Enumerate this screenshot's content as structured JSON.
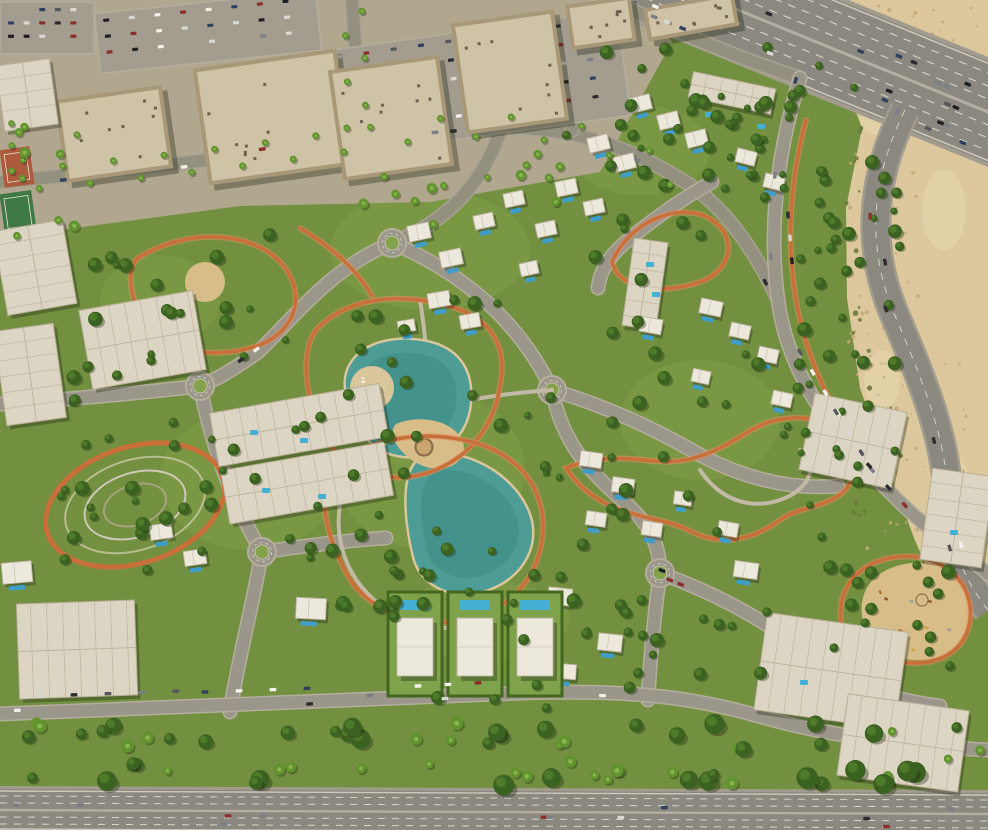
{
  "scene": {
    "canvas": {
      "w": 988,
      "h": 830
    },
    "palette": {
      "grass": "#72903f",
      "grassLight": "#84a24c",
      "treeDark": "#3c6222",
      "tree": "#4e7b2a",
      "treeLight": "#6d9b3c",
      "palm": "#61942f",
      "palmLight": "#8ab44e",
      "pavement": "#b1a78f",
      "plaza": "#bcb29a",
      "desert": "#dcc89c",
      "desertLight": "#e6d6ae",
      "desertSpeckle": "#c4a878",
      "shrub": "#6b7a3a",
      "road": "#9b968a",
      "roadCasing": "#b6ae9d",
      "highway": "#8b8880",
      "laneWhite": "#e8e4d8",
      "laneSoft": "#b5afa2",
      "track": "#c96f3a",
      "trackLight": "#e09263",
      "lake": "#4d9c96",
      "lakeDeep": "#3b8781",
      "sandEdge": "#d9c79b",
      "sand": "#d8bd88",
      "pool": "#3e9ec9",
      "poolLight": "#45b0d6",
      "villa": "#ece8dc",
      "villaLine": "#bdb4a0",
      "aptRoof": "#ddd5c3",
      "aptLine": "#b9ae97",
      "wall": "#a89878",
      "roof": "#cfc3a7",
      "wallDark": "#97886c",
      "roofDark": "#b3a183",
      "lot": "#a39d90",
      "hedge": "#44671f",
      "plotLawn": "#7ea34a",
      "carColors": [
        "#f2f0ea",
        "#d8d8d4",
        "#2b2b30",
        "#55575c",
        "#8a2f2a",
        "#31405f",
        "#7b7e84",
        "#1f1f24"
      ],
      "shadow": "rgba(30,36,18,0.35)"
    },
    "urbanPoly": "0,0 645,0 672,42 600,172 430,202 240,206 90,226 0,238",
    "desertPoly": "838,0 988,0 988,598 940,598 914,538 888,468 860,388 847,298 846,208 862,128 838,66 812,28",
    "desertPatches": [
      [
        900,
        60,
        70,
        26
      ],
      [
        944,
        210,
        44,
        80
      ],
      [
        882,
        380,
        36,
        60
      ],
      [
        950,
        480,
        36,
        50
      ],
      [
        880,
        120,
        40,
        30
      ]
    ],
    "speckleZones": [
      [
        848,
        6,
        130,
        110,
        60,
        41
      ],
      [
        848,
        150,
        70,
        260,
        50,
        42
      ],
      [
        866,
        350,
        100,
        240,
        55,
        43
      ]
    ],
    "shrubZones": [
      [
        846,
        120,
        40,
        200,
        22,
        44
      ],
      [
        852,
        330,
        50,
        200,
        18,
        45
      ]
    ],
    "grassPatches": [
      [
        430,
        250,
        200,
        120
      ],
      [
        250,
        480,
        180,
        140
      ],
      [
        700,
        420,
        160,
        120
      ],
      [
        640,
        150,
        140,
        90
      ],
      [
        160,
        300,
        120,
        90
      ],
      [
        480,
        620,
        180,
        80
      ],
      [
        430,
        470,
        190,
        160
      ]
    ],
    "highway": {
      "x1": 640,
      "y1": -30,
      "x2": 1020,
      "y2": 125,
      "half": 47,
      "dashOffsets": [
        -36,
        -24,
        -12,
        12,
        24,
        36
      ],
      "edgeOffsets": [
        -45,
        45
      ]
    },
    "bottomHighway": {
      "x1": 0,
      "y1": 810,
      "x2": 988,
      "y2": 814,
      "half": 21,
      "dashOffsets": [
        -14,
        -7,
        7,
        14
      ],
      "edgeOffsets": [
        -19,
        19
      ]
    },
    "ramp": {
      "d": "M 905,110 C 870,180 866,250 896,318 C 922,380 944,432 948,492 C 950,540 960,575 988,610",
      "w": 26
    },
    "streets": [
      "M 0,182 C 130,170 250,156 355,140",
      "M 355,140 C 430,126 500,122 560,132 C 610,140 650,160 690,185 C 720,205 750,240 778,300",
      "M 500,132 C 480,190 440,225 392,243",
      "M 352,0 C 356,52 358,96 355,140",
      "M 608,0 C 600,50 588,95 572,130",
      "M 628,8 C 690,38 750,62 800,78"
    ],
    "roads": [
      "M 392,243 C 330,268 292,320 258,352 C 230,372 215,380 200,386",
      "M 200,386 C 212,448 232,502 262,552",
      "M 262,552 C 252,608 238,660 230,712",
      "M 200,386 C 130,394 60,400 0,404",
      "M 392,243 C 462,272 520,322 552,390",
      "M 552,390 C 562,442 588,470 622,500 C 650,523 660,546 660,573",
      "M 660,573 C 654,618 650,660 648,700",
      "M 660,573 C 716,594 762,618 802,650 C 842,682 888,700 940,706",
      "M 800,78 C 778,150 768,225 778,300 C 790,392 858,462 906,508 C 944,543 968,556 988,574",
      "M 552,390 C 612,408 656,430 702,456 C 744,478 790,490 838,486",
      "M 0,714 C 180,707 360,698 520,693 C 640,689 700,699 762,717 C 824,735 904,746 988,750",
      "M 262,552 C 306,546 348,540 386,538",
      "M 712,182 C 680,200 650,222 628,240 C 610,255 600,270 598,288"
    ],
    "roundabouts": [
      [
        200,
        386
      ],
      [
        262,
        552
      ],
      [
        660,
        573
      ],
      [
        392,
        243
      ],
      [
        552,
        390
      ]
    ],
    "walkPaths": [
      "M 420,300 C 428,350 430,400 432,445",
      "M 352,470 C 330,510 335,560 368,594 C 400,628 450,636 492,620",
      "M 552,390 C 520,392 492,396 470,400",
      "M 700,470 C 720,500 750,510 780,500 C 810,490 820,464 800,450"
    ],
    "tracks": [
      "M 138,258 C 186,228 252,230 282,264 C 306,292 298,328 262,344 C 216,362 158,352 140,316 C 130,294 126,268 138,258 Z",
      "M 316,330 C 344,300 392,292 442,304 C 492,316 508,346 500,386 C 494,426 470,458 430,472 C 390,486 348,472 328,442 C 310,416 296,358 316,330 Z",
      "M 334,470 C 362,440 420,428 472,442 C 524,456 548,494 542,540 C 536,582 506,612 464,620 C 420,629 368,612 348,576 C 330,544 314,498 334,470 Z",
      "M 566,468 C 624,446 652,470 694,458 C 744,444 752,416 802,418 C 842,420 862,448 852,478 C 842,508 802,504 780,520 C 750,542 718,546 688,530 C 658,514 600,520 566,468 Z",
      "M 612,262 C 630,220 682,200 712,220 C 738,238 732,270 700,282 C 664,294 620,292 612,262 Z",
      "M 846,640 C 830,600 850,566 890,558 C 930,550 966,572 970,606 C 974,640 950,664 914,663 C 884,662 856,662 846,640 Z",
      "M 300,228 C 330,246 356,268 372,296",
      "M 806,120 C 790,180 786,240 796,300 C 806,360 836,420 872,470"
    ],
    "ovalPark": {
      "cx": 135,
      "cy": 505,
      "rx": 92,
      "ry": 58,
      "rot": -18,
      "rings": [
        [
          72,
          45
        ],
        [
          52,
          32
        ],
        [
          32,
          20
        ]
      ]
    },
    "lakes": [
      {
        "d": "M 346,386 C 344,356 374,338 410,340 C 452,342 472,364 470,400 C 468,436 442,458 406,456 C 368,454 348,418 346,386 Z",
        "cx": 408,
        "cy": 398
      },
      {
        "d": "M 428,456 C 468,448 518,478 530,518 C 540,554 512,586 476,592 C 446,597 420,582 414,556 C 406,524 398,462 428,456 Z",
        "cx": 472,
        "cy": 524
      }
    ],
    "beach": {
      "cx": 372,
      "cy": 388,
      "r": 22
    },
    "plazaSand": "M 396,424 C 420,414 452,420 462,440 C 470,458 452,472 430,468 C 406,463 384,436 396,424 Z",
    "plazaRing": [
      424,
      447
    ],
    "parkSandCircle": [
      205,
      282,
      20
    ],
    "playgroundSand": "M 862,616 C 858,586 880,566 912,563 C 948,560 968,580 970,610 C 972,640 950,661 916,660 C 884,659 866,644 862,616 Z",
    "midrises": [
      [
        60,
        92,
        108,
        84,
        -8
      ],
      [
        200,
        58,
        145,
        118,
        -8
      ],
      [
        335,
        62,
        112,
        112,
        -8
      ],
      [
        458,
        16,
        104,
        112,
        -8
      ],
      [
        568,
        0,
        66,
        46,
        -8
      ],
      [
        645,
        0,
        92,
        34,
        -10
      ]
    ],
    "apartments": [
      [
        690,
        80,
        84,
        26,
        12
      ],
      [
        628,
        240,
        34,
        88,
        8
      ],
      [
        0,
        225,
        70,
        85,
        -10
      ],
      [
        85,
        300,
        115,
        80,
        -10
      ],
      [
        0,
        327,
        60,
        95,
        -8
      ],
      [
        213,
        398,
        172,
        54,
        -10
      ],
      [
        224,
        456,
        166,
        54,
        -10
      ],
      [
        18,
        602,
        118,
        95,
        -2
      ],
      [
        806,
        402,
        94,
        78,
        12
      ],
      [
        926,
        472,
        62,
        92,
        8
      ],
      [
        760,
        622,
        142,
        98,
        8
      ],
      [
        842,
        702,
        122,
        82,
        8
      ],
      [
        0,
        62,
        54,
        66,
        -8
      ]
    ],
    "aptPools": [
      [
        705,
        112
      ],
      [
        731,
        118
      ],
      [
        757,
        124
      ],
      [
        646,
        262
      ],
      [
        652,
        292
      ],
      [
        250,
        430
      ],
      [
        300,
        438
      ],
      [
        262,
        488
      ],
      [
        318,
        494
      ],
      [
        836,
        452
      ],
      [
        950,
        530
      ],
      [
        800,
        680
      ]
    ],
    "villas": [
      [
        630,
        96,
        21,
        15,
        -14
      ],
      [
        658,
        113,
        21,
        15,
        -14
      ],
      [
        686,
        131,
        21,
        15,
        -14
      ],
      [
        588,
        136,
        21,
        15,
        -14
      ],
      [
        614,
        155,
        21,
        15,
        -14
      ],
      [
        556,
        180,
        21,
        15,
        -12
      ],
      [
        584,
        200,
        20,
        14,
        -12
      ],
      [
        536,
        222,
        20,
        14,
        -12
      ],
      [
        736,
        150,
        20,
        14,
        14
      ],
      [
        764,
        175,
        20,
        14,
        14
      ],
      [
        408,
        224,
        22,
        16,
        -12
      ],
      [
        440,
        250,
        22,
        16,
        -12
      ],
      [
        474,
        214,
        20,
        14,
        -12
      ],
      [
        504,
        192,
        20,
        14,
        -12
      ],
      [
        428,
        292,
        22,
        15,
        -10
      ],
      [
        460,
        314,
        20,
        14,
        -10
      ],
      [
        398,
        320,
        17,
        12,
        -10
      ],
      [
        520,
        262,
        18,
        13,
        -12
      ],
      [
        640,
        318,
        22,
        15,
        10
      ],
      [
        700,
        300,
        22,
        15,
        12
      ],
      [
        730,
        324,
        20,
        14,
        12
      ],
      [
        758,
        348,
        20,
        14,
        12
      ],
      [
        692,
        370,
        18,
        13,
        12
      ],
      [
        772,
        392,
        20,
        14,
        12
      ],
      [
        580,
        452,
        22,
        15,
        8
      ],
      [
        612,
        478,
        22,
        15,
        8
      ],
      [
        586,
        512,
        20,
        14,
        8
      ],
      [
        642,
        522,
        20,
        14,
        8
      ],
      [
        674,
        492,
        18,
        13,
        8
      ],
      [
        718,
        522,
        20,
        14,
        10
      ],
      [
        548,
        588,
        24,
        17,
        6
      ],
      [
        598,
        634,
        24,
        17,
        6
      ],
      [
        554,
        664,
        22,
        15,
        4
      ],
      [
        734,
        562,
        24,
        16,
        8
      ],
      [
        296,
        598,
        30,
        21,
        3
      ],
      [
        150,
        524,
        22,
        15,
        -8
      ],
      [
        184,
        550,
        22,
        15,
        -8
      ],
      [
        2,
        562,
        30,
        21,
        -5
      ]
    ],
    "villaPlots": [
      [
        388,
        592
      ],
      [
        448,
        592
      ],
      [
        508,
        592
      ]
    ],
    "parking": [
      [
        333,
        30,
        292,
        106,
        -8,
        5,
        10
      ],
      [
        97,
        2,
        222,
        60,
        -6,
        3,
        8
      ],
      [
        0,
        2,
        94,
        52,
        0,
        3,
        5
      ]
    ],
    "tennis": [
      [
        2,
        148,
        30,
        38,
        -8
      ],
      [
        2,
        192,
        32,
        40,
        -8
      ]
    ],
    "treeZones": [
      [
        600,
        40,
        260,
        160,
        26,
        11,
        "t"
      ],
      [
        795,
        150,
        105,
        400,
        42,
        12,
        "t"
      ],
      [
        0,
        722,
        988,
        64,
        72,
        13,
        "m"
      ],
      [
        300,
        300,
        260,
        320,
        30,
        14,
        "t"
      ],
      [
        60,
        230,
        240,
        360,
        36,
        15,
        "t"
      ],
      [
        540,
        70,
        260,
        230,
        26,
        16,
        "t"
      ],
      [
        820,
        560,
        160,
        115,
        16,
        17,
        "t"
      ],
      [
        560,
        300,
        260,
        260,
        22,
        18,
        "t"
      ],
      [
        380,
        560,
        220,
        150,
        18,
        19,
        "t"
      ],
      [
        0,
        100,
        80,
        140,
        12,
        20,
        "p"
      ],
      [
        340,
        150,
        240,
        80,
        14,
        21,
        "p"
      ],
      [
        620,
        600,
        180,
        110,
        16,
        22,
        "t"
      ],
      [
        60,
        390,
        160,
        150,
        14,
        23,
        "t"
      ],
      [
        300,
        500,
        120,
        110,
        10,
        24,
        "t"
      ]
    ],
    "palmPaths": [
      {
        "d": "M 0,182 C 130,170 250,156 355,140",
        "n": 14,
        "off": 10
      },
      {
        "d": "M 355,140 C 430,126 500,122 560,132 C 610,140 650,160 690,185",
        "n": 10,
        "off": 10
      },
      {
        "d": "M 352,0 C 356,52 358,96 355,140",
        "n": 6,
        "off": 9
      }
    ],
    "carRows": [
      [
        40,
        696,
        -2,
        5,
        34
      ],
      [
        205,
        692,
        -2,
        4,
        34
      ],
      [
        418,
        686,
        -3,
        3,
        30
      ],
      [
        800,
        352,
        58,
        4,
        24
      ],
      [
        836,
        412,
        58,
        4,
        24
      ],
      [
        872,
        470,
        47,
        3,
        24
      ],
      [
        788,
        215,
        85,
        3,
        23
      ]
    ],
    "carFlows": [
      {
        "d": "M 640,-30 L 1020,125",
        "n": 26,
        "lanes": [
          -38,
          -28,
          -18,
          -8,
          8,
          18,
          28,
          38
        ],
        "seed": 31
      },
      {
        "d": "M 905,110 C 870,180 866,250 896,318 C 922,380 944,432 948,492 C 950,540 960,575 988,610",
        "n": 7,
        "lanes": [
          -6,
          6
        ],
        "seed": 32
      },
      {
        "d": "M 0,810 L 988,814",
        "n": 12,
        "lanes": [
          -13,
          -5,
          5,
          13
        ],
        "seed": 33
      },
      {
        "d": "M 0,714 C 180,707 360,698 520,693 C 640,689 700,699 762,717 C 824,735 904,746 988,750",
        "n": 5,
        "lanes": [
          -3,
          3
        ],
        "seed": 34
      },
      {
        "d": "M 800,78 C 778,150 768,225 778,300 C 790,392 858,462 906,508",
        "n": 4,
        "lanes": [
          -3.5,
          3.5
        ],
        "seed": 35
      },
      {
        "d": "M 355,140 C 430,126 500,122 560,132 C 610,140 650,160 690,185 C 720,205 750,240 778,300",
        "n": 4,
        "lanes": [
          -3.5,
          3.5
        ],
        "seed": 36
      },
      {
        "d": "M 0,182 C 130,170 250,156 355,140",
        "n": 3,
        "lanes": [
          -4,
          4
        ],
        "seed": 37
      },
      {
        "d": "M 392,243 C 330,268 292,320 258,352 C 230,372 215,380 200,386",
        "n": 2,
        "lanes": [
          -3,
          3
        ],
        "seed": 38
      },
      {
        "d": "M 660,573 C 716,594 762,618 802,650 C 842,682 888,700 940,706",
        "n": 3,
        "lanes": [
          -3,
          3
        ],
        "seed": 39
      }
    ]
  }
}
